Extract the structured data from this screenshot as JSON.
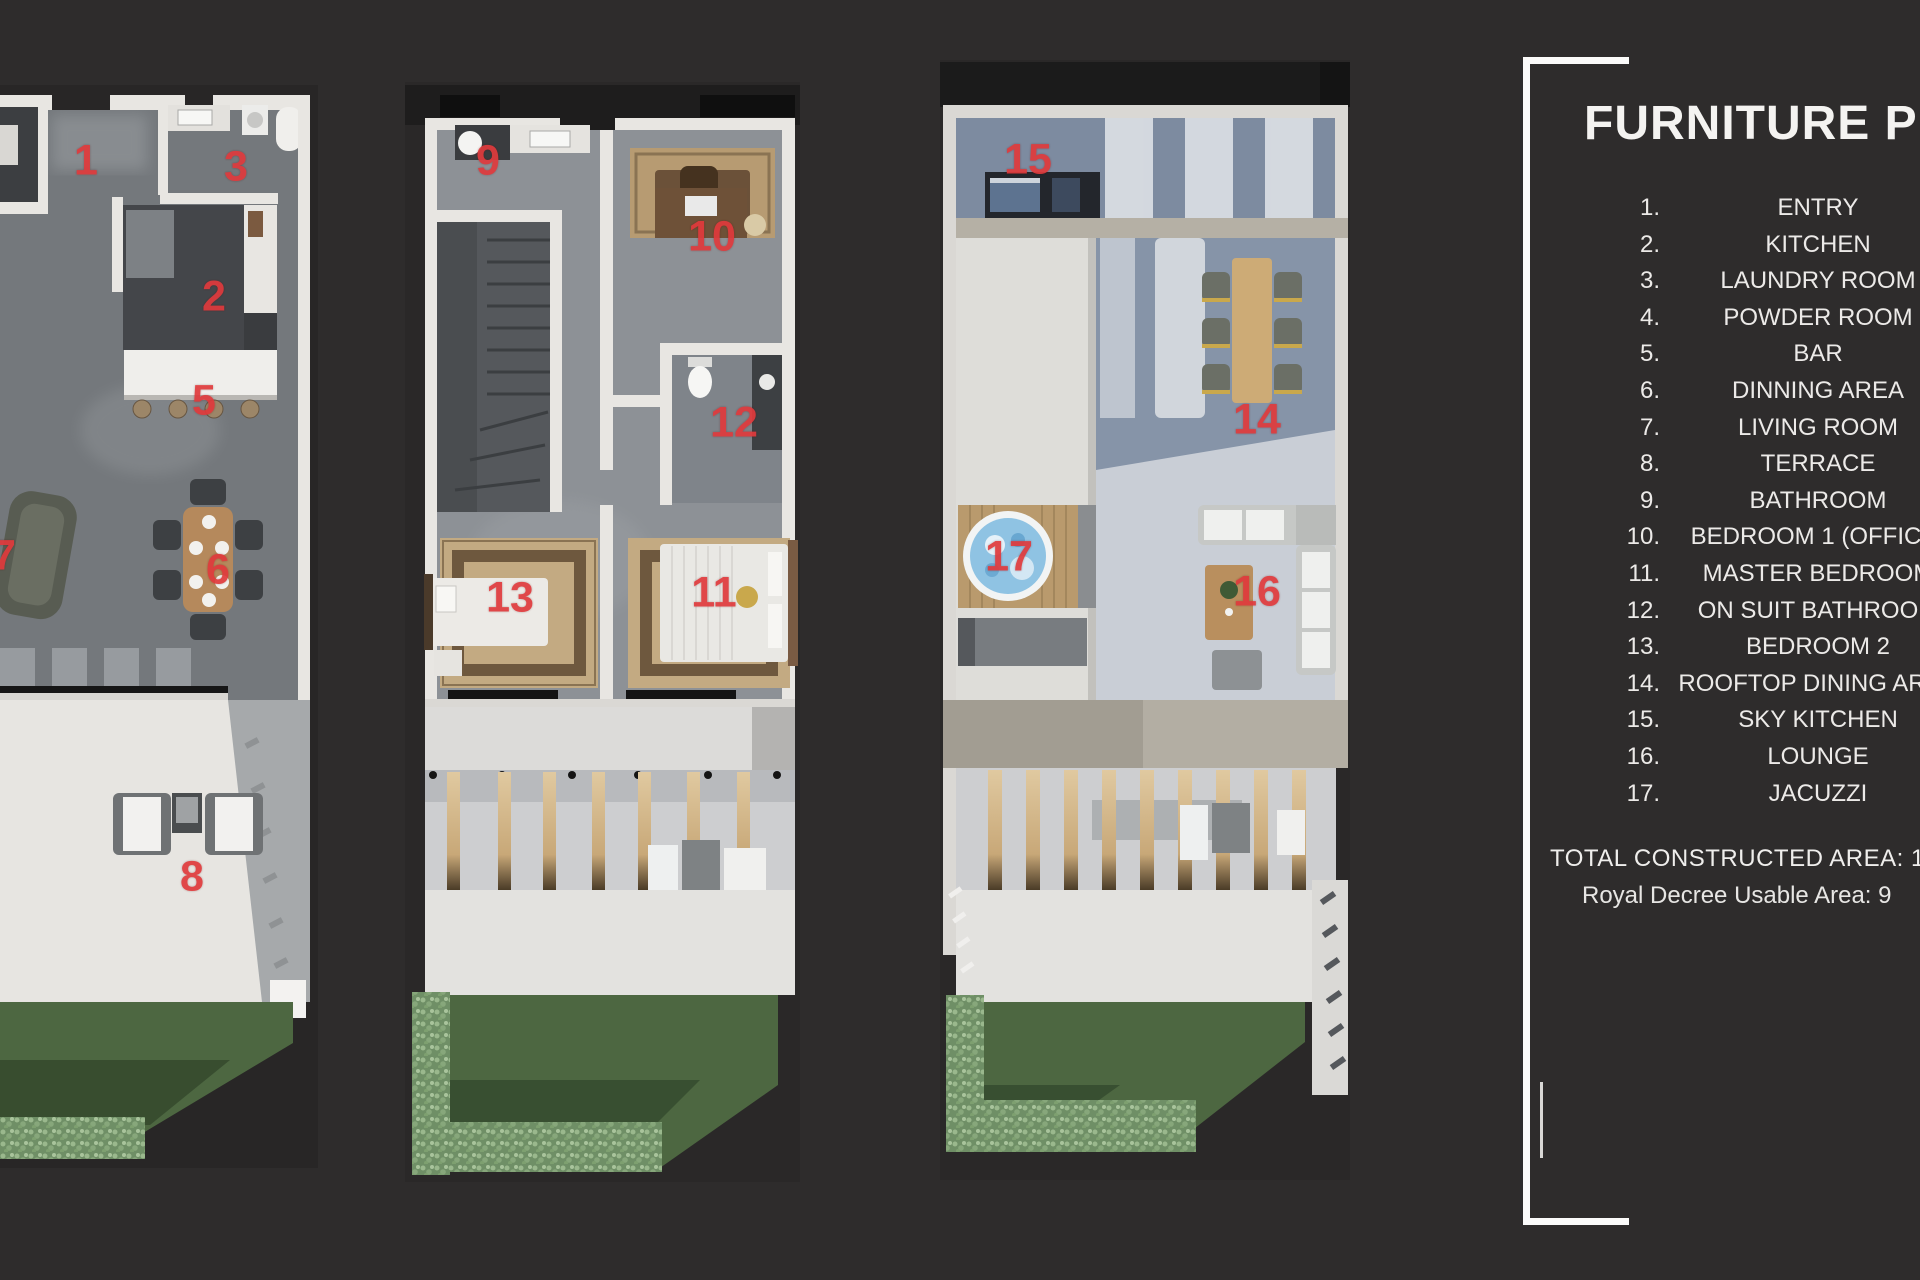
{
  "page": {
    "background": "#2e2c2c",
    "accent_red": "#e03a3c"
  },
  "legend": {
    "title": "FURNITURE PLAN",
    "items": [
      {
        "num": "1.",
        "label": "ENTRY"
      },
      {
        "num": "2.",
        "label": "KITCHEN"
      },
      {
        "num": "3.",
        "label": "LAUNDRY ROOM"
      },
      {
        "num": "4.",
        "label": "POWDER ROOM"
      },
      {
        "num": "5.",
        "label": "BAR"
      },
      {
        "num": "6.",
        "label": "DINNING AREA"
      },
      {
        "num": "7.",
        "label": "LIVING ROOM"
      },
      {
        "num": "8.",
        "label": "TERRACE"
      },
      {
        "num": "9.",
        "label": "BATHROOM"
      },
      {
        "num": "10.",
        "label": "BEDROOM 1 (OFFICE)"
      },
      {
        "num": "11.",
        "label": "MASTER BEDROOM"
      },
      {
        "num": "12.",
        "label": "ON SUIT BATHROOM"
      },
      {
        "num": "13.",
        "label": "BEDROOM 2"
      },
      {
        "num": "14.",
        "label": "ROOFTOP DINING AREA"
      },
      {
        "num": "15.",
        "label": "SKY KITCHEN"
      },
      {
        "num": "16.",
        "label": "LOUNGE"
      },
      {
        "num": "17.",
        "label": "JACUZZI"
      }
    ],
    "footer": {
      "line1": "TOTAL CONSTRUCTED AREA: 1",
      "line2": "Royal Decree Usable Area: 9"
    }
  },
  "plans": [
    {
      "id": "ground-floor",
      "markers": [
        {
          "n": "1",
          "x": 86,
          "y": 161
        },
        {
          "n": "3",
          "x": 236,
          "y": 167
        },
        {
          "n": "2",
          "x": 214,
          "y": 297
        },
        {
          "n": "5",
          "x": 204,
          "y": 401
        },
        {
          "n": "7",
          "x": 4,
          "y": 556
        },
        {
          "n": "6",
          "x": 218,
          "y": 570
        },
        {
          "n": "8",
          "x": 192,
          "y": 877
        }
      ]
    },
    {
      "id": "first-floor",
      "markers": [
        {
          "n": "9",
          "x": 488,
          "y": 161
        },
        {
          "n": "10",
          "x": 712,
          "y": 237
        },
        {
          "n": "12",
          "x": 734,
          "y": 423
        },
        {
          "n": "13",
          "x": 510,
          "y": 598
        },
        {
          "n": "11",
          "x": 714,
          "y": 593
        }
      ]
    },
    {
      "id": "rooftop",
      "markers": [
        {
          "n": "15",
          "x": 1028,
          "y": 160
        },
        {
          "n": "14",
          "x": 1257,
          "y": 420
        },
        {
          "n": "17",
          "x": 1009,
          "y": 557
        },
        {
          "n": "16",
          "x": 1257,
          "y": 592
        }
      ]
    }
  ]
}
